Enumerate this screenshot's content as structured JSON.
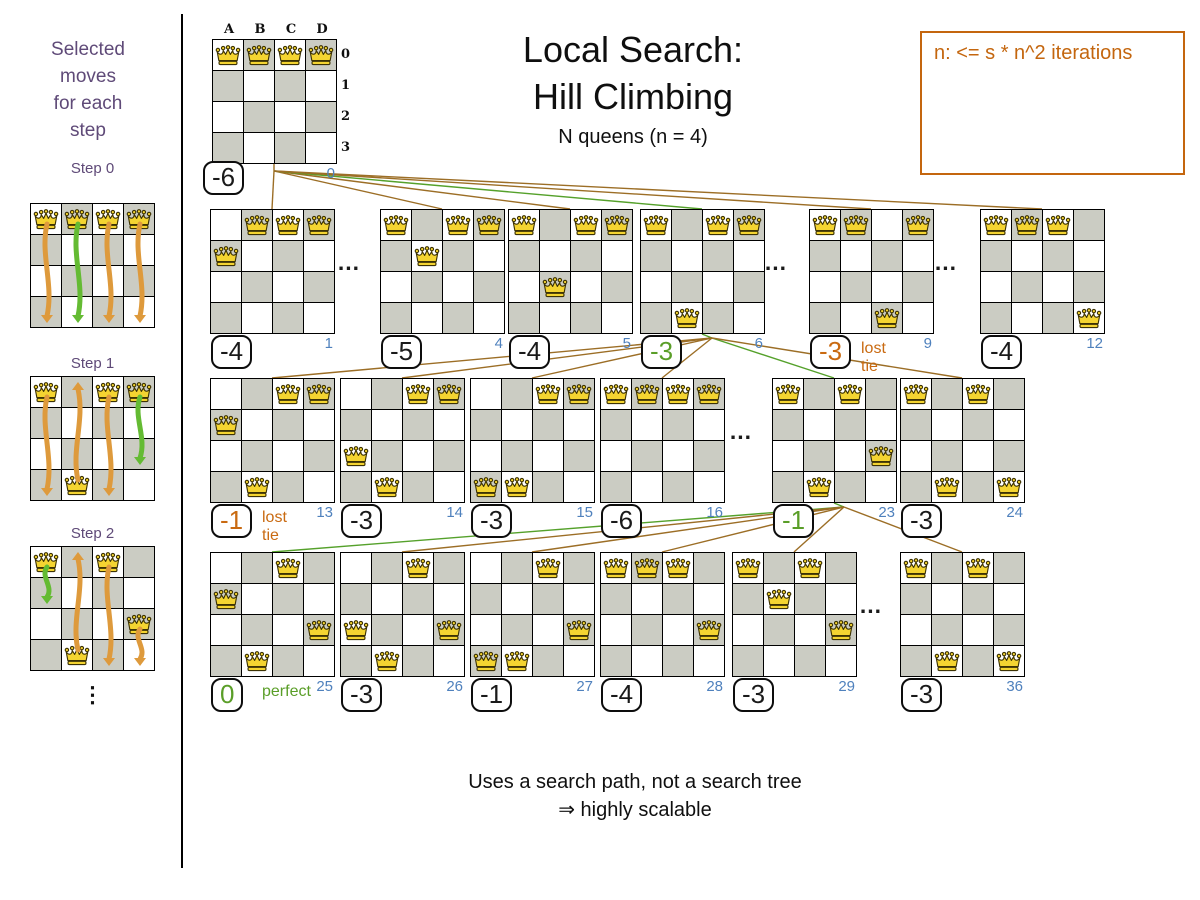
{
  "colors": {
    "board_dark": "#cbccc3",
    "line_brown": "#9c6e26",
    "line_green": "#55a12b",
    "score_black": "#1a1a1a",
    "score_green": "#5a9e28",
    "score_orange": "#c96a11",
    "index_blue": "#4f81bd",
    "purple": "#5f4a78",
    "note_orange": "#c4660e",
    "queen_fill": "#f4d431",
    "queen_stroke": "#3d3304",
    "arrow_orange": "#de9a3c",
    "arrow_green": "#64bb33"
  },
  "title": {
    "line1": "Local Search:",
    "line2": "Hill Climbing",
    "subtitle": "N queens (n = 4)"
  },
  "note": {
    "text": "n: <= s * n^2 iterations"
  },
  "sidebar": {
    "heading_lines": [
      "Selected",
      "moves",
      "for each",
      "step"
    ],
    "ellipsis": "⋮",
    "steps": [
      {
        "label": "Step 0",
        "y": 203,
        "label_y": 160,
        "queens": [
          [
            0,
            0
          ],
          [
            1,
            0
          ],
          [
            2,
            0
          ],
          [
            3,
            0
          ]
        ],
        "arrows": [
          {
            "col": 0,
            "from": 0,
            "to": 3,
            "color": "orange"
          },
          {
            "col": 1,
            "from": 0,
            "to": 3,
            "color": "green"
          },
          {
            "col": 2,
            "from": 0,
            "to": 3,
            "color": "orange"
          },
          {
            "col": 3,
            "from": 0,
            "to": 3,
            "color": "orange"
          }
        ]
      },
      {
        "label": "Step 1",
        "y": 376,
        "label_y": 355,
        "queens": [
          [
            0,
            0
          ],
          [
            2,
            0
          ],
          [
            3,
            0
          ],
          [
            1,
            3
          ]
        ],
        "arrows": [
          {
            "col": 0,
            "from": 0,
            "to": 3,
            "color": "orange"
          },
          {
            "col": 1,
            "from": 3,
            "to": 0,
            "color": "orange"
          },
          {
            "col": 2,
            "from": 0,
            "to": 3,
            "color": "orange"
          },
          {
            "col": 3,
            "from": 0,
            "to": 2,
            "color": "green"
          }
        ]
      },
      {
        "label": "Step 2",
        "y": 546,
        "label_y": 525,
        "queens": [
          [
            0,
            0
          ],
          [
            2,
            0
          ],
          [
            3,
            2
          ],
          [
            1,
            3
          ]
        ],
        "arrows": [
          {
            "col": 0,
            "from": 0,
            "to": 1,
            "color": "green"
          },
          {
            "col": 1,
            "from": 3,
            "to": 0,
            "color": "orange"
          },
          {
            "col": 2,
            "from": 0,
            "to": 3,
            "color": "orange"
          },
          {
            "col": 3,
            "from": 2,
            "to": 3,
            "color": "orange"
          }
        ]
      }
    ]
  },
  "root": {
    "x": 212,
    "y": 39,
    "index": "0",
    "score": "-6",
    "queens": [
      [
        0,
        0
      ],
      [
        1,
        0
      ],
      [
        2,
        0
      ],
      [
        3,
        0
      ]
    ],
    "col_labels": [
      "A",
      "B",
      "C",
      "D"
    ],
    "row_labels": [
      "0",
      "1",
      "2",
      "3"
    ]
  },
  "tree_rows": [
    {
      "y": 209,
      "dots_x": [
        349,
        776,
        946
      ],
      "boards": [
        {
          "x": 210,
          "index": "1",
          "score": "-4",
          "style": "black",
          "queens": [
            [
              1,
              0
            ],
            [
              2,
              0
            ],
            [
              3,
              0
            ],
            [
              0,
              1
            ]
          ]
        },
        {
          "x": 380,
          "index": "4",
          "score": "-5",
          "style": "black",
          "queens": [
            [
              0,
              0
            ],
            [
              2,
              0
            ],
            [
              3,
              0
            ],
            [
              1,
              1
            ]
          ]
        },
        {
          "x": 508,
          "index": "5",
          "score": "-4",
          "style": "black",
          "queens": [
            [
              0,
              0
            ],
            [
              2,
              0
            ],
            [
              3,
              0
            ],
            [
              1,
              2
            ]
          ]
        },
        {
          "x": 640,
          "index": "6",
          "score": "-3",
          "style": "green",
          "selected": true,
          "queens": [
            [
              0,
              0
            ],
            [
              2,
              0
            ],
            [
              3,
              0
            ],
            [
              1,
              3
            ]
          ]
        },
        {
          "x": 809,
          "index": "9",
          "score": "-3",
          "style": "orange",
          "tag": "lost tie",
          "queens": [
            [
              0,
              0
            ],
            [
              1,
              0
            ],
            [
              3,
              0
            ],
            [
              2,
              3
            ]
          ]
        },
        {
          "x": 980,
          "index": "12",
          "score": "-4",
          "style": "black",
          "queens": [
            [
              0,
              0
            ],
            [
              1,
              0
            ],
            [
              2,
              0
            ],
            [
              3,
              3
            ]
          ]
        }
      ]
    },
    {
      "y": 378,
      "dots_x": [
        741
      ],
      "boards": [
        {
          "x": 210,
          "index": "13",
          "score": "-1",
          "style": "orange",
          "tag": "lost tie",
          "queens": [
            [
              2,
              0
            ],
            [
              3,
              0
            ],
            [
              0,
              1
            ],
            [
              1,
              3
            ]
          ]
        },
        {
          "x": 340,
          "index": "14",
          "score": "-3",
          "style": "black",
          "queens": [
            [
              2,
              0
            ],
            [
              3,
              0
            ],
            [
              0,
              2
            ],
            [
              1,
              3
            ]
          ]
        },
        {
          "x": 470,
          "index": "15",
          "score": "-3",
          "style": "black",
          "queens": [
            [
              2,
              0
            ],
            [
              3,
              0
            ],
            [
              0,
              3
            ],
            [
              1,
              3
            ]
          ]
        },
        {
          "x": 600,
          "index": "16",
          "score": "-6",
          "style": "black",
          "queens": [
            [
              0,
              0
            ],
            [
              1,
              0
            ],
            [
              2,
              0
            ],
            [
              3,
              0
            ]
          ]
        },
        {
          "x": 772,
          "index": "23",
          "score": "-1",
          "style": "green",
          "selected": true,
          "queens": [
            [
              0,
              0
            ],
            [
              2,
              0
            ],
            [
              3,
              2
            ],
            [
              1,
              3
            ]
          ]
        },
        {
          "x": 900,
          "index": "24",
          "score": "-3",
          "style": "black",
          "queens": [
            [
              0,
              0
            ],
            [
              2,
              0
            ],
            [
              1,
              3
            ],
            [
              3,
              3
            ]
          ]
        }
      ]
    },
    {
      "y": 552,
      "dots_x": [
        871
      ],
      "boards": [
        {
          "x": 210,
          "index": "25",
          "score": "0",
          "style": "green",
          "tag": "perfect",
          "queens": [
            [
              2,
              0
            ],
            [
              0,
              1
            ],
            [
              3,
              2
            ],
            [
              1,
              3
            ]
          ]
        },
        {
          "x": 340,
          "index": "26",
          "score": "-3",
          "style": "black",
          "queens": [
            [
              2,
              0
            ],
            [
              0,
              2
            ],
            [
              3,
              2
            ],
            [
              1,
              3
            ]
          ]
        },
        {
          "x": 470,
          "index": "27",
          "score": "-1",
          "style": "black",
          "queens": [
            [
              2,
              0
            ],
            [
              0,
              3
            ],
            [
              3,
              2
            ],
            [
              1,
              3
            ]
          ]
        },
        {
          "x": 600,
          "index": "28",
          "score": "-4",
          "style": "black",
          "queens": [
            [
              0,
              0
            ],
            [
              1,
              0
            ],
            [
              2,
              0
            ],
            [
              3,
              2
            ]
          ]
        },
        {
          "x": 732,
          "index": "29",
          "score": "-3",
          "style": "black",
          "queens": [
            [
              0,
              0
            ],
            [
              2,
              0
            ],
            [
              1,
              1
            ],
            [
              3,
              2
            ]
          ]
        },
        {
          "x": 900,
          "index": "36",
          "score": "-3",
          "style": "black",
          "queens": [
            [
              0,
              0
            ],
            [
              2,
              0
            ],
            [
              1,
              3
            ],
            [
              3,
              3
            ]
          ]
        }
      ]
    }
  ],
  "footer": {
    "line1": "Uses a search path, not a search tree",
    "line2": "⇒ highly scalable"
  }
}
